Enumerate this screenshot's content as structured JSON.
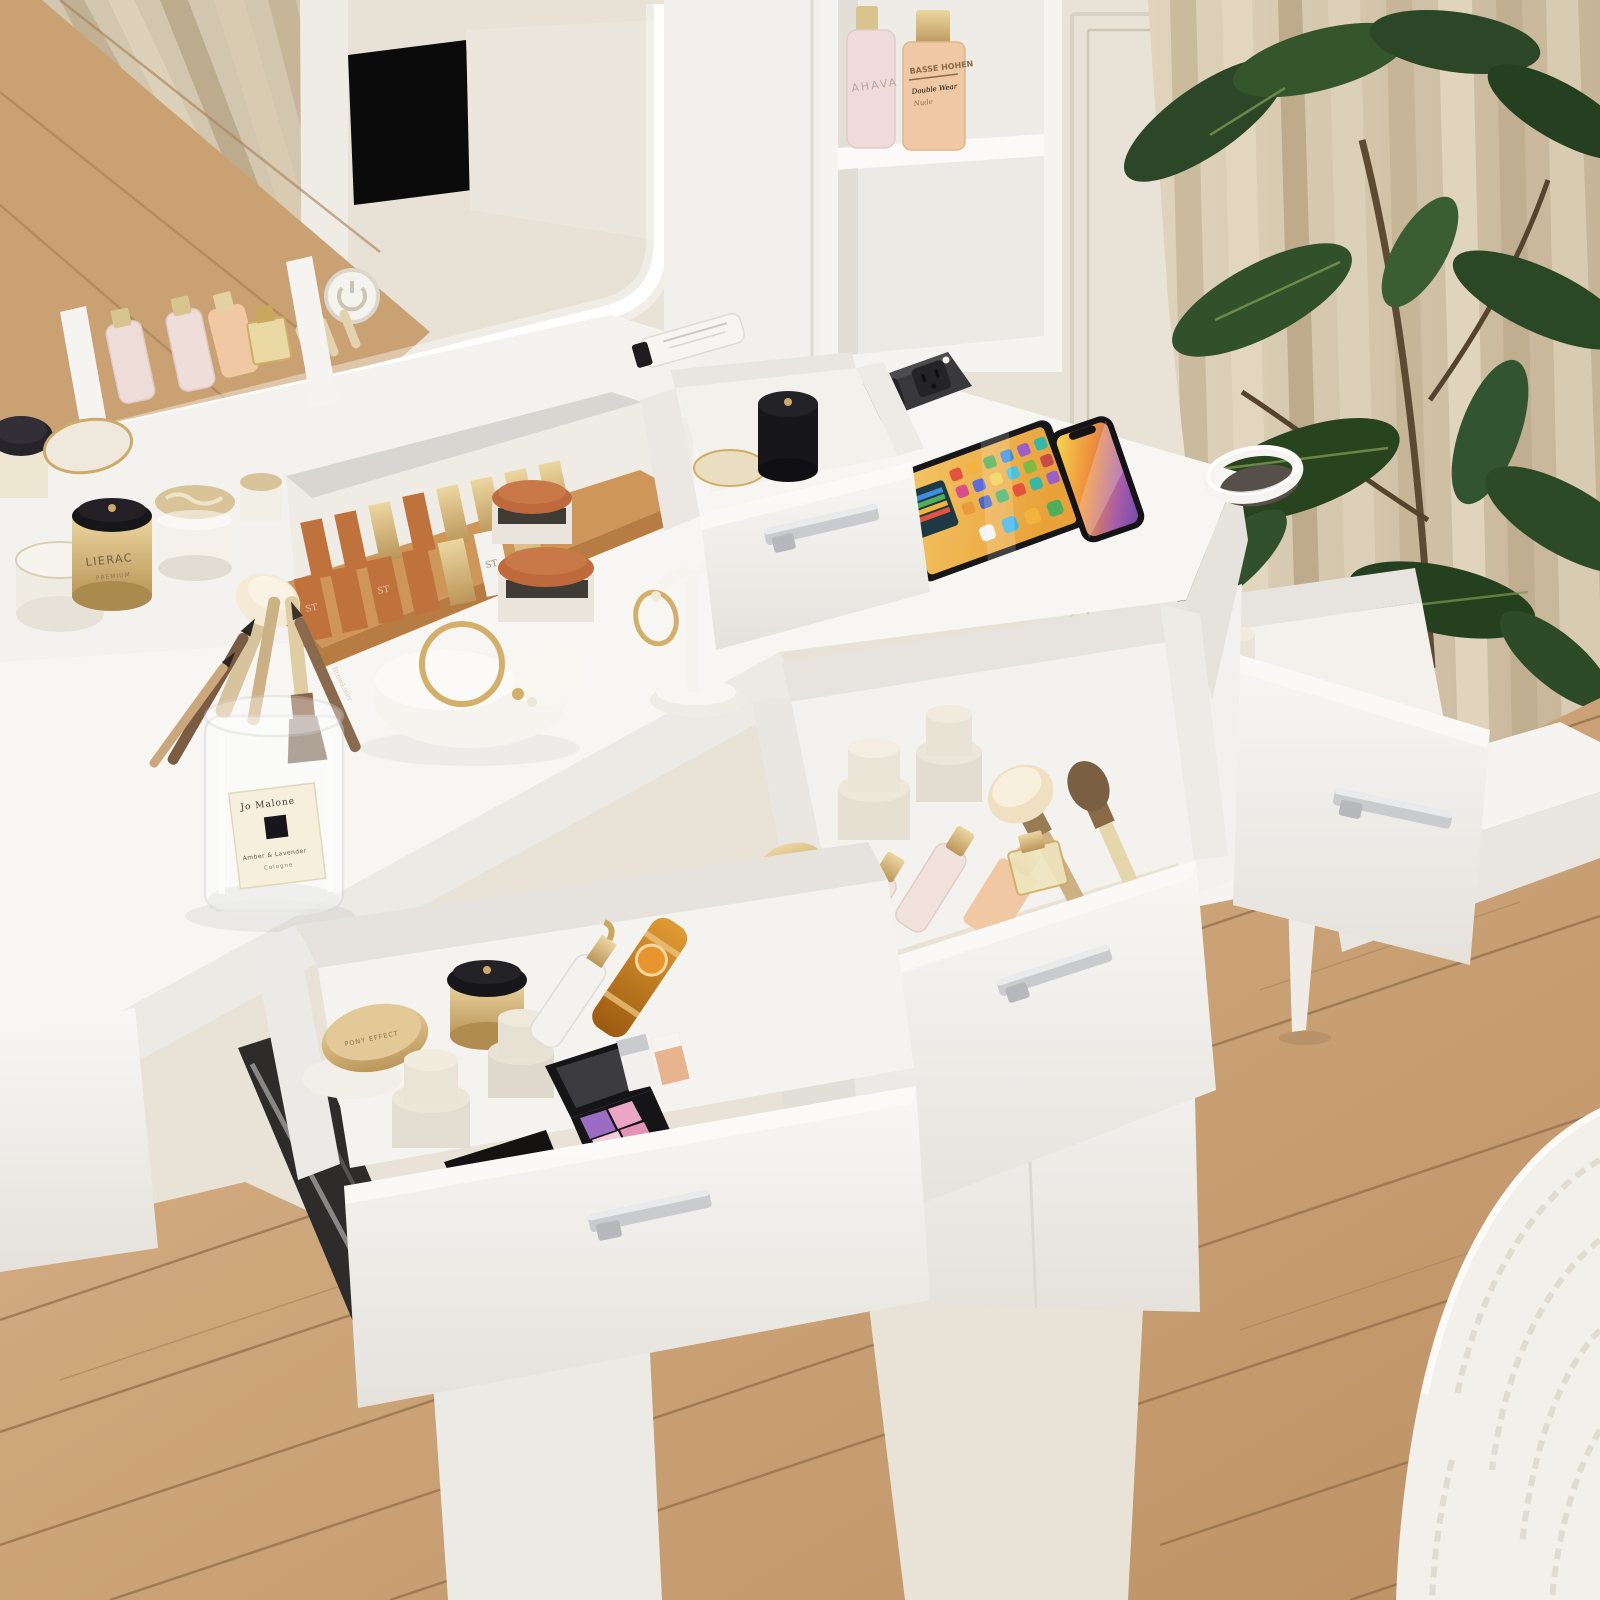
{
  "scene": {
    "title": "White LED vanity dressing table with open cosmetic drawers",
    "setting": "Bedroom corner with beige curtains, panelled wall, potted rubber plant, oak plank floor and a knit rug",
    "objects": [
      "led-vanity-mirror",
      "touch-switch",
      "wall-shelf-tower",
      "power-strip",
      "tablet",
      "smartphone",
      "charging-ring",
      "organizer-tray",
      "lipstick-tray",
      "earring-stand",
      "brush-cup",
      "jewelry-holder",
      "top-drawer",
      "left-drawer",
      "middle-drawer",
      "side-table-drawer",
      "pedestal-cabinet",
      "side-table",
      "potted-plant",
      "curtains",
      "wainscot-wall",
      "oak-floor",
      "knit-rug"
    ]
  },
  "labels": {
    "shelf_bottle_1": "AHAVA",
    "shelf_bottle_2_brand": "BASSE HOHEN",
    "shelf_bottle_2_line1": "Double Wear",
    "shelf_bottle_2_line2": "Nude",
    "cream_jar": "LIERAC",
    "cream_jar_sub": "PREMIUM",
    "brush_cup_brand": "Jo Malone",
    "brush_cup_product": "Amber & Lavender",
    "brush_cup_type": "Cologne",
    "lipstick_monogram": "ST",
    "brush_handle": "QVS",
    "brow_pencil": "BrowLiner",
    "drawer_compact": "PONY EFFECT",
    "black_pouch": "Dior",
    "spray_bottle": "AHAVA"
  },
  "colors": {
    "wall": "#e9e2d7",
    "wainscot_line": "#d4cabb",
    "curtain_light": "#dbcfb8",
    "curtain_dark": "#c3b295",
    "mirror_reflection": "#e7e1d6",
    "led": "#ffffff",
    "furniture_white": "#f7f6f3",
    "furniture_shadow": "#e2dfda",
    "floor_light": "#d9b68b",
    "floor_dark": "#bf9466",
    "floor_seam": "#8f6c49",
    "rug": "#f2f0ea",
    "plant_dark": "#243f20",
    "plant_light": "#7c9751",
    "stem_brown": "#5d4a33",
    "power_strip": "#39383a",
    "handle_silver": "#c9cbce",
    "gold": "#cfa967",
    "terracotta": "#c0723d",
    "amber": "#c47a1f",
    "palette_purple": "#9a6cc2",
    "palette_pink": "#eba6c6",
    "tablet_screen": "#eda93f",
    "phone_screen_violet": "#8d5bb0"
  }
}
